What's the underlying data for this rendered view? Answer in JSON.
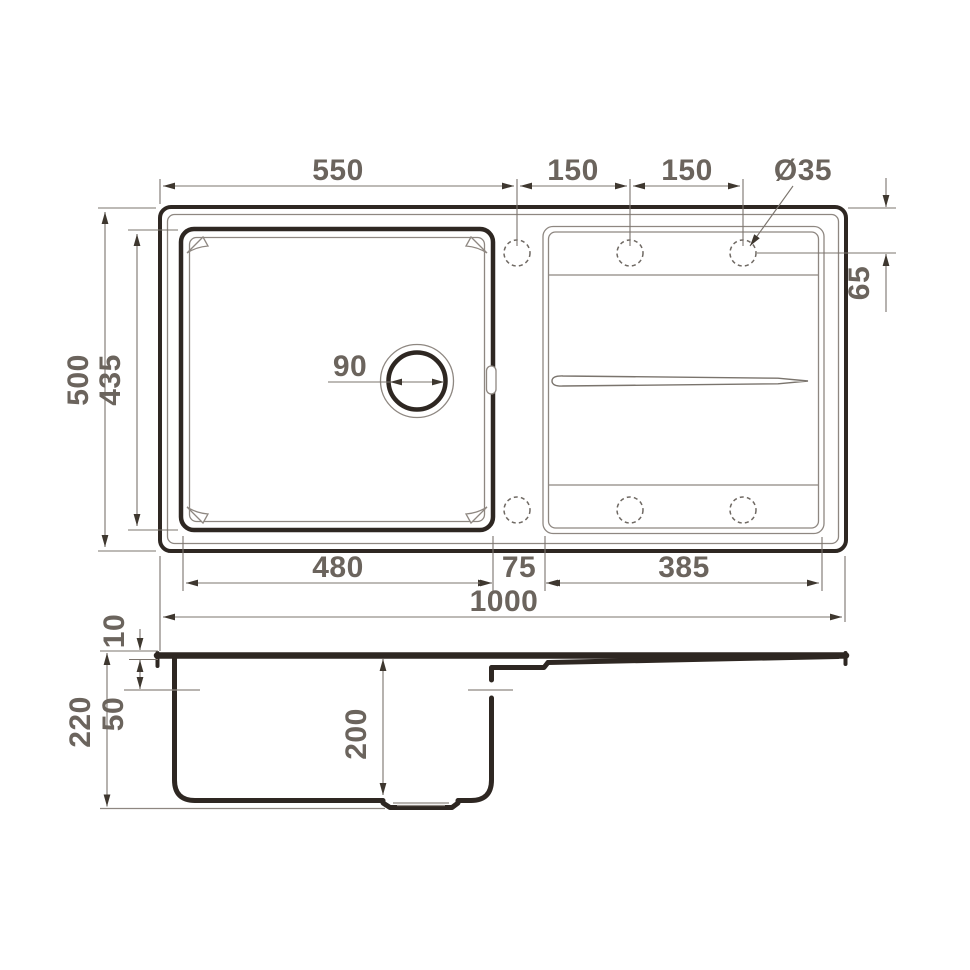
{
  "colors": {
    "background": "#ffffff",
    "outline": "#2e2722",
    "thin_line": "#8e8781",
    "dimension_line": "#7b746d",
    "dimension_text": "#6b645d",
    "arrow": "#3e372f"
  },
  "top_view": {
    "dim_top_width": "550",
    "dim_hole_spacing_1": "150",
    "dim_hole_spacing_2": "150",
    "dim_hole_diameter": "Ø35",
    "dim_hole_offset": "65",
    "dim_overall_depth": "500",
    "dim_bowl_depth": "435",
    "dim_drain_diameter": "90",
    "dim_bowl_width": "480",
    "dim_ledge_width": "75",
    "dim_drainboard_width": "385",
    "dim_overall_width": "1000"
  },
  "side_view": {
    "dim_rim_thickness": "10",
    "dim_overall_height": "220",
    "dim_overflow_level": "50",
    "dim_bowl_height": "200"
  }
}
